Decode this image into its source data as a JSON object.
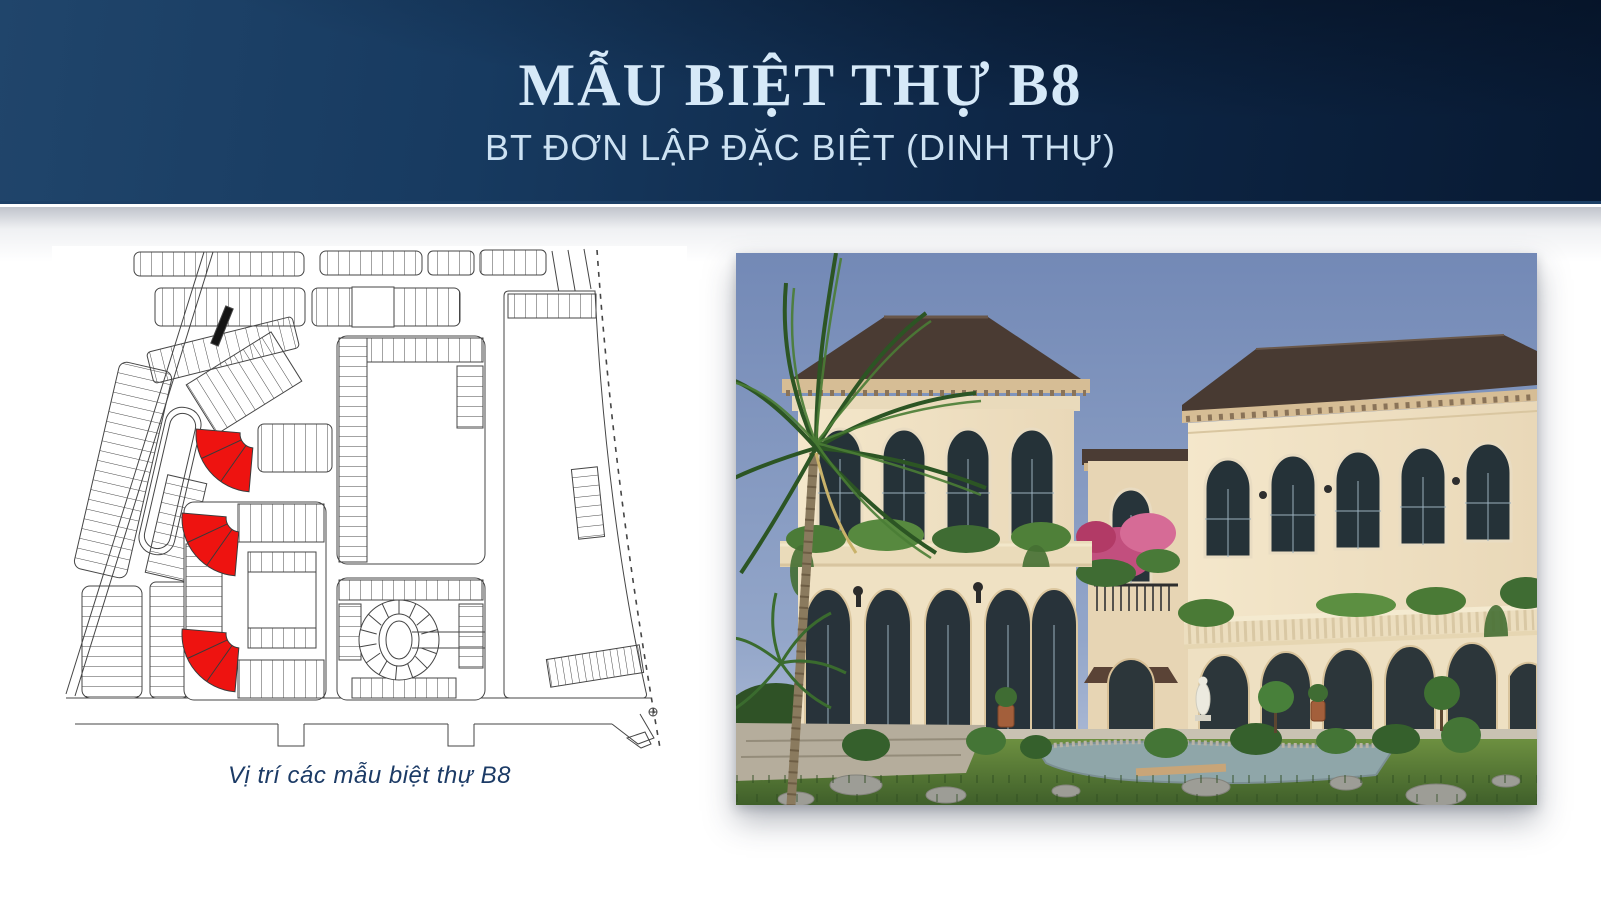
{
  "header": {
    "title": "MẪU BIỆT THỰ B8",
    "subtitle": "BT ĐƠN LẬP ĐẶC BIỆT (DINH THỰ)"
  },
  "site_plan": {
    "caption": "Vị trí các mẫu biệt thự B8",
    "highlighted_lot_count": 3,
    "highlight_color": "#ee1310"
  },
  "colors": {
    "banner_left": "#20456b",
    "banner_right": "#081a33",
    "title_text": "#d6e9f8",
    "subtitle_text": "#cde2f3",
    "caption_text": "#1c3b66",
    "page_background": "#ffffff"
  }
}
